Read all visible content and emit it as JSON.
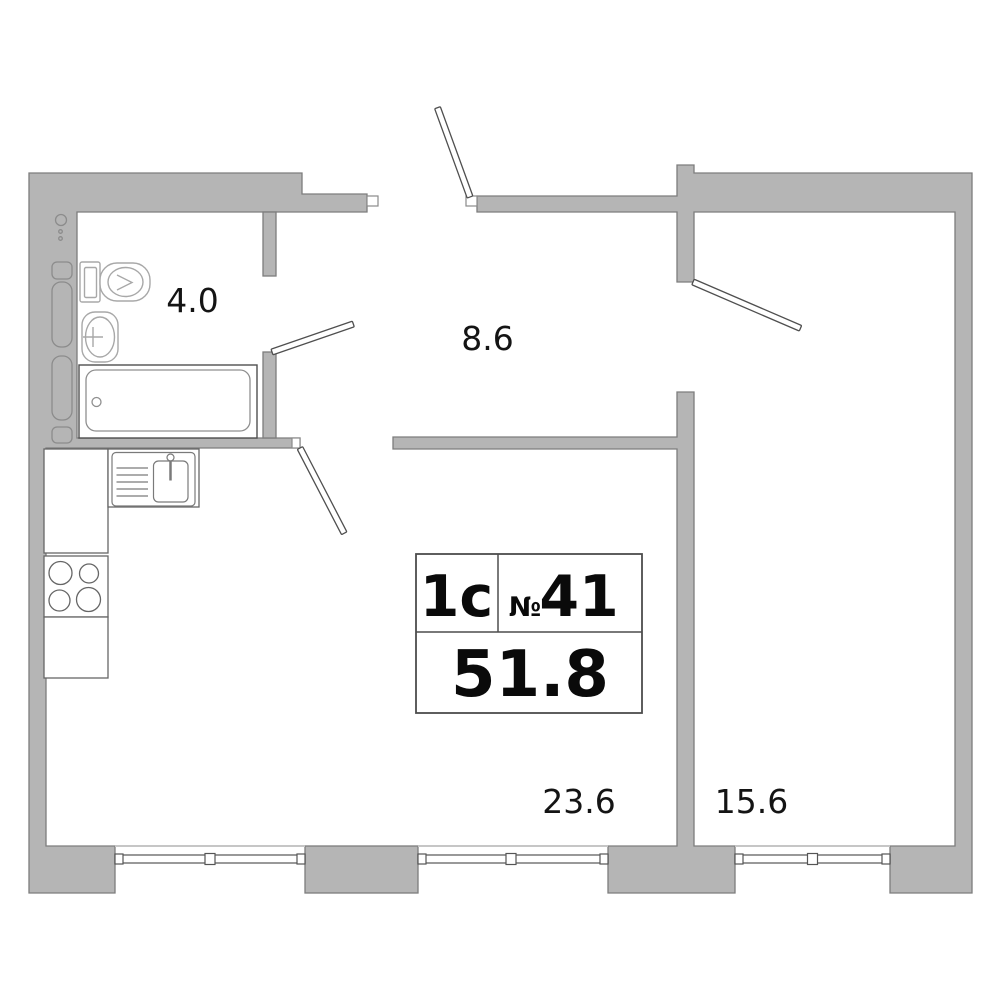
{
  "plan": {
    "unit_badge": {
      "type_label": "1с",
      "number_sign": "№",
      "number": "41",
      "total_area": "51.8"
    },
    "rooms": [
      {
        "id": "bathroom",
        "area_label": "4.0"
      },
      {
        "id": "hallway",
        "area_label": "8.6"
      },
      {
        "id": "kitchen-living-room",
        "area_label": "23.6"
      },
      {
        "id": "bedroom",
        "area_label": "15.6"
      }
    ],
    "colors": {
      "wall_fill": "#b5b5b5",
      "wall_stroke": "#7d7d7d",
      "outline_dark": "#4f4f4f",
      "fixture_stroke": "#a8a8a8",
      "counter_stroke": "#666666",
      "window_stroke": "#555555",
      "label_text": "#141414"
    }
  }
}
